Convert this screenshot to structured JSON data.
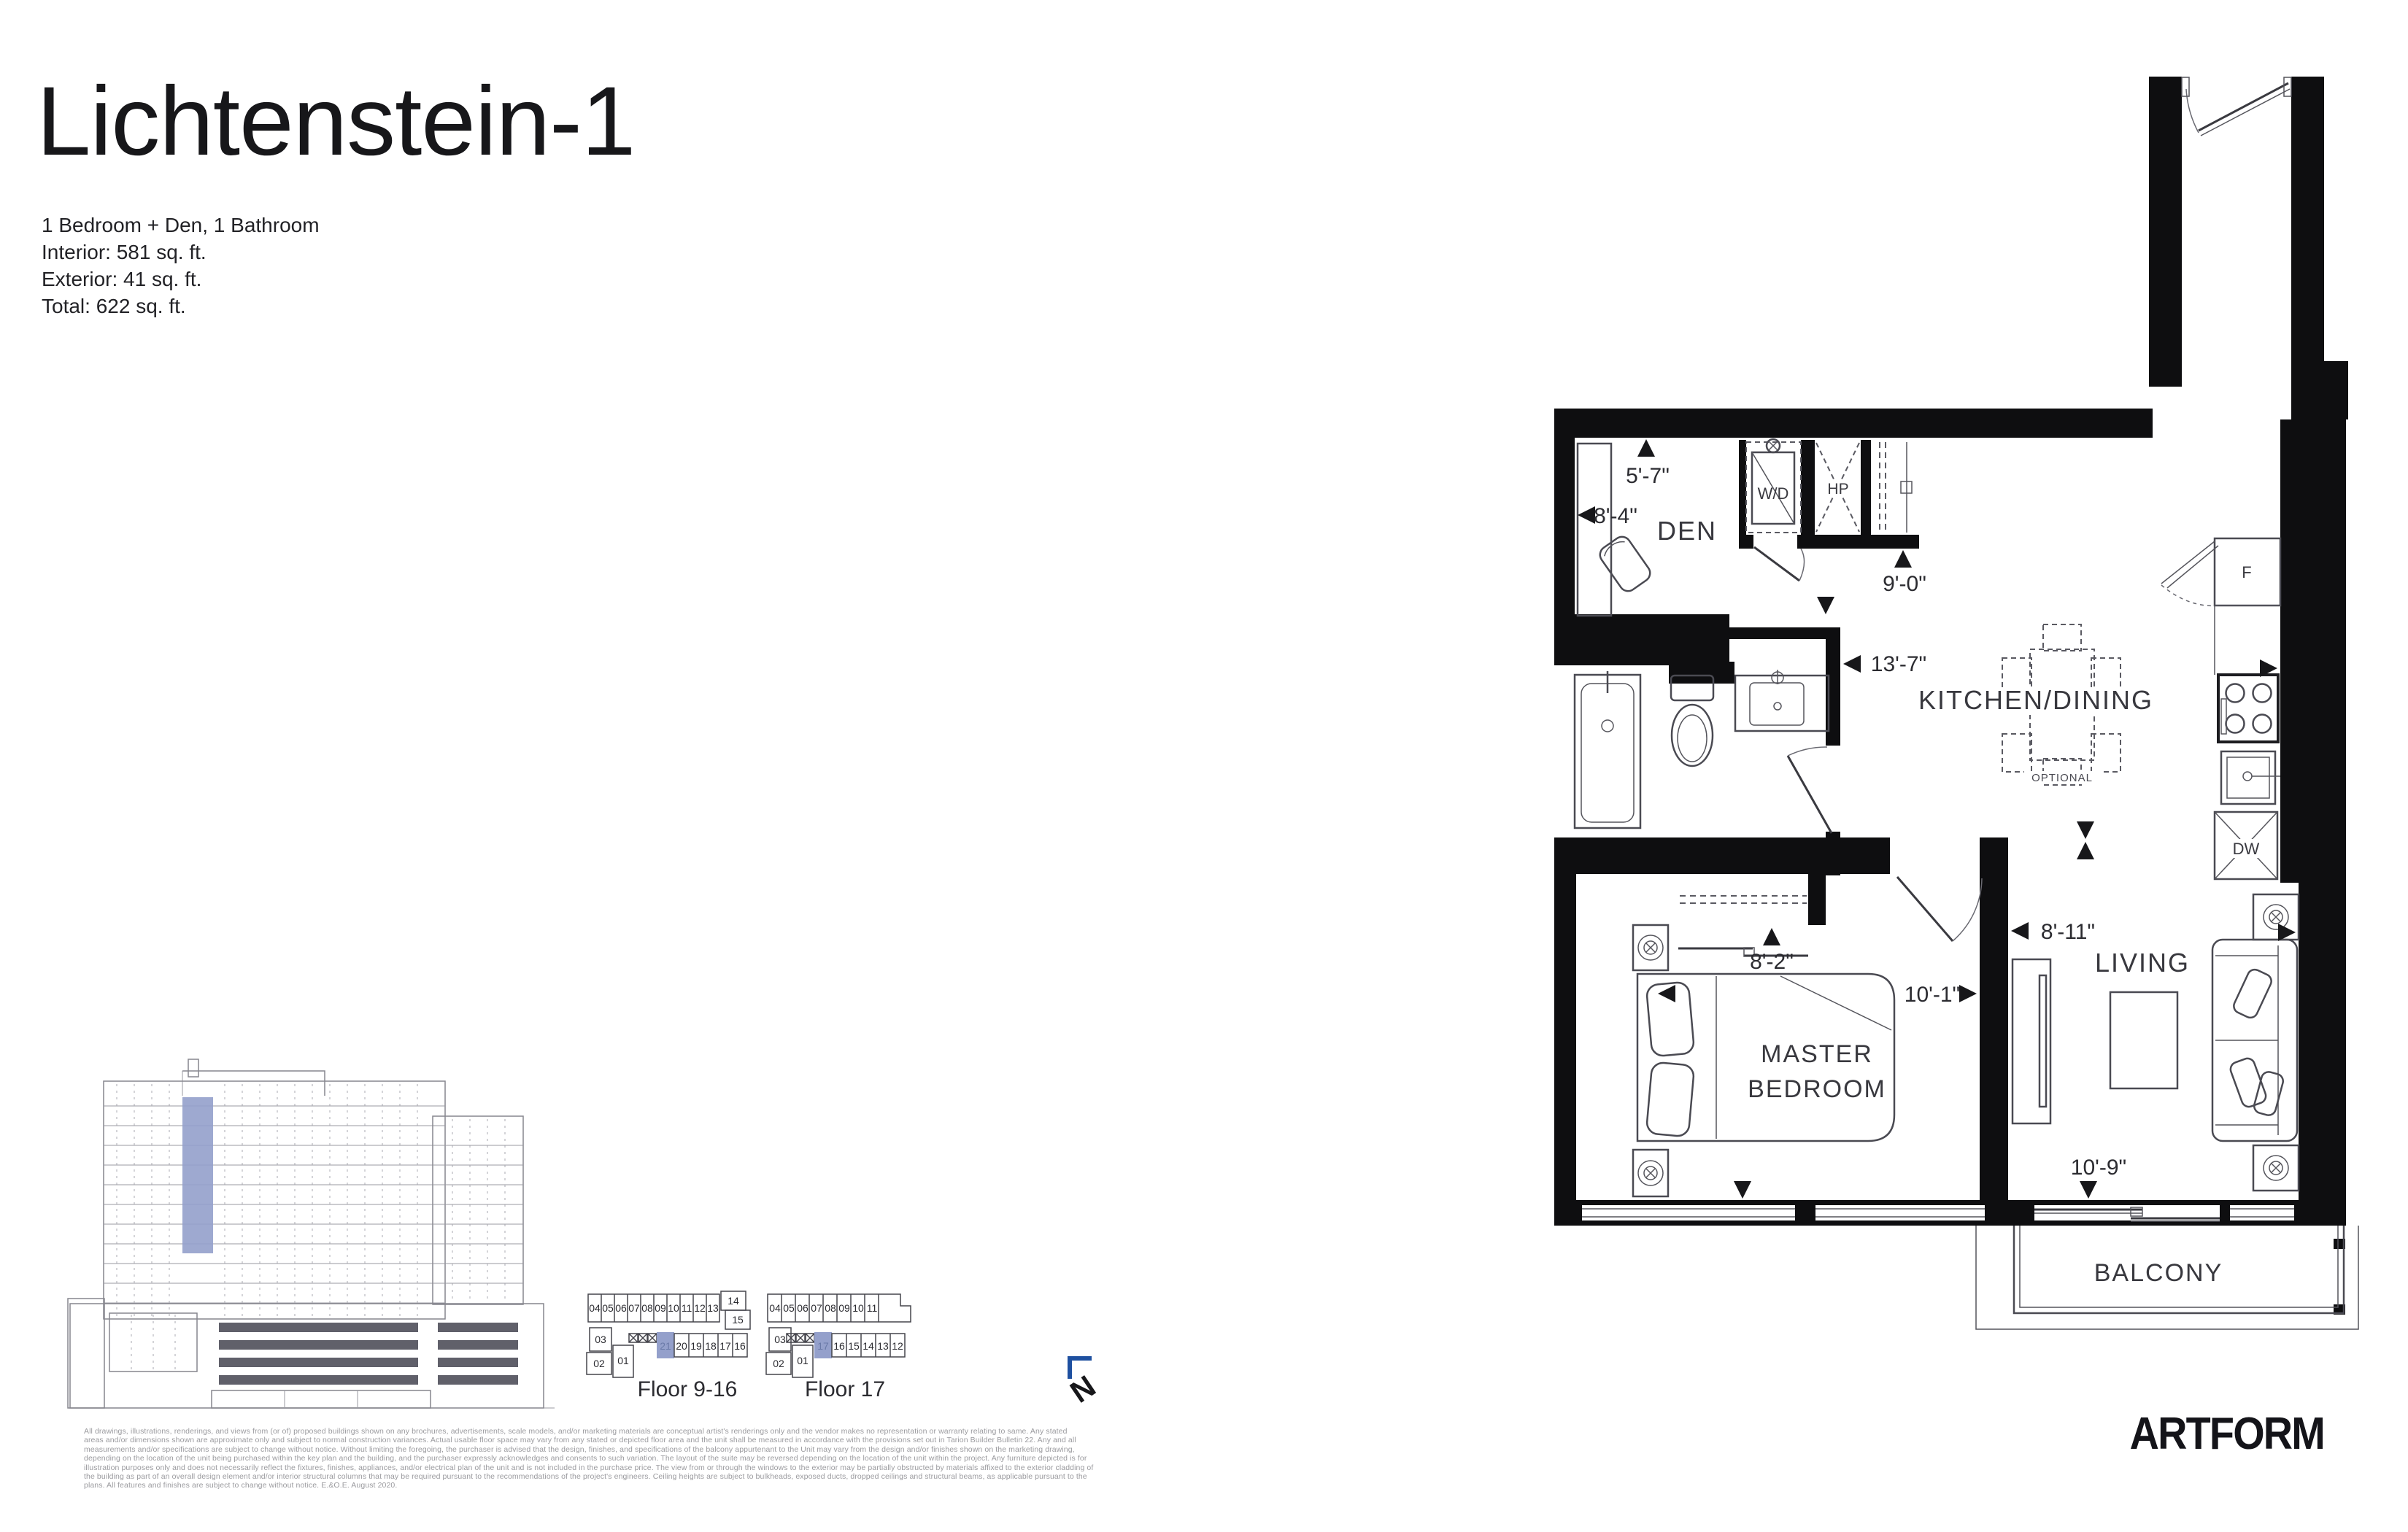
{
  "page": {
    "title": "Lichtenstein-1",
    "specs": [
      "1 Bedroom + Den, 1 Bathroom",
      "Interior: 581 sq. ft.",
      "Exterior: 41 sq. ft.",
      "Total: 622 sq. ft."
    ]
  },
  "floorplan": {
    "rooms": {
      "den": "DEN",
      "kitchen_dining": "KITCHEN/DINING",
      "master_line1": "MASTER",
      "master_line2": "BEDROOM",
      "living": "LIVING",
      "balcony": "BALCONY"
    },
    "fixtures": {
      "washer_dryer": "W/D",
      "heat_pump": "HP",
      "fridge": "F",
      "dishwasher": "DW",
      "optional": "OPTIONAL"
    },
    "dimensions": {
      "den_width": "5'-7\"",
      "den_depth": "8'-4\"",
      "hall": "9'-0\"",
      "kitchen": "13'-7\"",
      "bedroom_width": "8'-2\"",
      "bedroom_depth": "10'-1\"",
      "living_width": "8'-11\"",
      "living_depth": "10'-9\""
    }
  },
  "keyplans": {
    "plan1": {
      "label": "Floor 9-16",
      "top_row": [
        "04",
        "05",
        "06",
        "07",
        "08",
        "09",
        "10",
        "11",
        "12",
        "13"
      ],
      "right_units": [
        "14",
        "15"
      ],
      "left_units": [
        "03",
        "02",
        "01"
      ],
      "bottom_row": [
        "20",
        "19",
        "18",
        "17",
        "16"
      ],
      "highlight": "21"
    },
    "plan2": {
      "label": "Floor 17",
      "top_row": [
        "04",
        "05",
        "06",
        "07",
        "08",
        "09",
        "10",
        "11"
      ],
      "left_units": [
        "03",
        "02",
        "01"
      ],
      "bottom_row": [
        "16",
        "15",
        "14",
        "13",
        "12"
      ],
      "highlight": "17"
    },
    "north": "N"
  },
  "disclaimer": {
    "lines": [
      "All drawings, illustrations, renderings, and views from (or of) proposed buildings shown on any brochures, advertisements, scale models, and/or marketing materials are conceptual artist's renderings only and the vendor makes no representation or warranty relating to same. Any stated",
      "areas and/or dimensions shown are approximate only and subject to normal construction variances. Actual usable floor space may vary from any stated or depicted floor area and the unit shall be measured in accordance with the provisions set out in Tarion Builder Bulletin 22. Any and all",
      "measurements and/or specifications are subject to change without notice. Without limiting the foregoing, the purchaser is advised that the design, finishes, and specifications of the balcony appurtenant to the Unit may vary from the design and/or finishes shown on the marketing drawing,",
      "depending on the location of the unit being purchased within the key plan and the building, and the purchaser expressly acknowledges and consents to such variation. The layout of the suite may be reversed depending on the location of the unit within the project. Any furniture depicted is for",
      "illustration purposes only and does not necessarily reflect the fixtures, finishes, appliances, and/or electrical plan of the unit and is not included in the purchase price. The view from or through the windows to the exterior may be partially obstructed by materials affixed to the exterior cladding of",
      "the building as part of an overall design element and/or interior structural columns that may be required pursuant to the recommendations of the project's engineers. Ceiling heights are subject to bulkheads, exposed ducts, dropped ceilings and structural beams, as applicable pursuant to the",
      "plans. All features and finishes are subject to change without notice. E.&O.E. August 2020."
    ]
  },
  "logo": "ARTFORM",
  "colors": {
    "unit_highlight": "#94A0CB",
    "north_arrow": "#1E50A0",
    "wall": "#0E0E10"
  }
}
